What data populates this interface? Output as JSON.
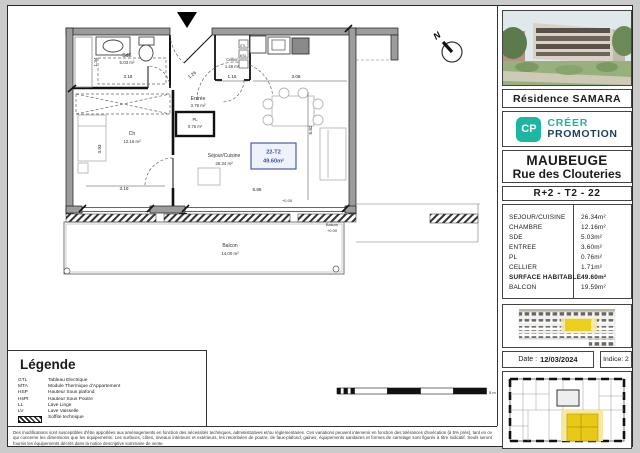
{
  "plan": {
    "north": "N",
    "scale": "5 m",
    "unit_tag": "22-T2",
    "unit_area": "49.60m²",
    "rooms": {
      "sde": {
        "n": "SdE",
        "a": "5.03 m²"
      },
      "cellier": {
        "n": "Cellier",
        "a": "1.46 m²"
      },
      "entree": {
        "n": "Entrée",
        "a": "3.76 m²"
      },
      "pl": {
        "n": "PL",
        "a": "0.76 m²"
      },
      "ch": {
        "n": "Ch",
        "a": "12.16 m²"
      },
      "sejour": {
        "n": "Séjour/Cuisine",
        "a": "26.34 m²"
      },
      "balcon": {
        "n": "Balcon",
        "a": "14,00 m²"
      }
    },
    "balcon_side": {
      "n": "Balcon",
      "lvl": "+0.00"
    },
    "level": "+0.00",
    "tech": {
      "gtl": "GTL",
      "mta": "MTA"
    },
    "dims": {
      "sde_h": "1.34",
      "sde_w": "3.18",
      "porte": "1.26",
      "cellier_w": "1.15",
      "cuisine_w": "3.08",
      "ch_h": "3.93",
      "ch_w": "3.10",
      "sejour_w": "5.85",
      "sejour_h": "5.82"
    }
  },
  "legend": {
    "title": "Légende",
    "items": [
      {
        "abbr": "GTL",
        "label": "Tableau Electrique"
      },
      {
        "abbr": "MTA",
        "label": "Module Thermique d'Appartement"
      },
      {
        "abbr": "HSP",
        "label": "Hauteur Sous plafond"
      },
      {
        "abbr": "HsPt",
        "label": "Hauteur Sous Poutre"
      },
      {
        "abbr": "LL",
        "label": "Lave Linge"
      },
      {
        "abbr": "LV",
        "label": "Lave Vaisselle"
      },
      {
        "abbr": "",
        "label": "Soffite technique"
      }
    ]
  },
  "sidebar": {
    "residence": "Résidence SAMARA",
    "logo": {
      "icon": "CP",
      "brand_top": "CRÉER",
      "brand_bottom": "PROMOTION"
    },
    "city": "MAUBEUGE",
    "street": "Rue des Clouteries",
    "unit_header": "R+2 - T2 - 22",
    "table": {
      "rows": [
        {
          "label": "SEJOUR/CUISINE",
          "value": "26.34m²"
        },
        {
          "label": "CHAMBRE",
          "value": "12.16m²"
        },
        {
          "label": "SDE",
          "value": "5.03m²"
        },
        {
          "label": "ENTREE",
          "value": "3.60m²"
        },
        {
          "label": "PL",
          "value": "0.76m²"
        },
        {
          "label": "CELLIER",
          "value": "1.71m²"
        },
        {
          "label": "SURFACE HABITABLE",
          "value": "49.60m²"
        },
        {
          "label": "BALCON",
          "value": "19.59m²"
        }
      ]
    },
    "date_label": "Date :",
    "date_value": "12/03/2024",
    "indice": "Indice: 2"
  },
  "footer": {
    "disclaimer": "Des modifications sont susceptibles d'être apportées aux aménagements en fonction des nécessités techniques, administratives et/ou réglementaires. Ces variations peuvent intervenir en fonction des tolérances d'exécution (à 5% près), tant en ce qui concerne les dimensions que les équipements. Les surfaces, côtes, niveaux intérieurs et extérieurs, les retombées de poutre, de faux-plafond, gaines, équipements sanitaires et formes de carrelage sont figurés à titre indicatif. Seuls seront fournis les équipements décrits dans la notice descriptive sommaire de vente."
  },
  "colors": {
    "highlight": "#eccf1e",
    "teal": "#1fb5a3",
    "navy": "#1d3f5e",
    "unit_blue": "#3c4f9e"
  }
}
